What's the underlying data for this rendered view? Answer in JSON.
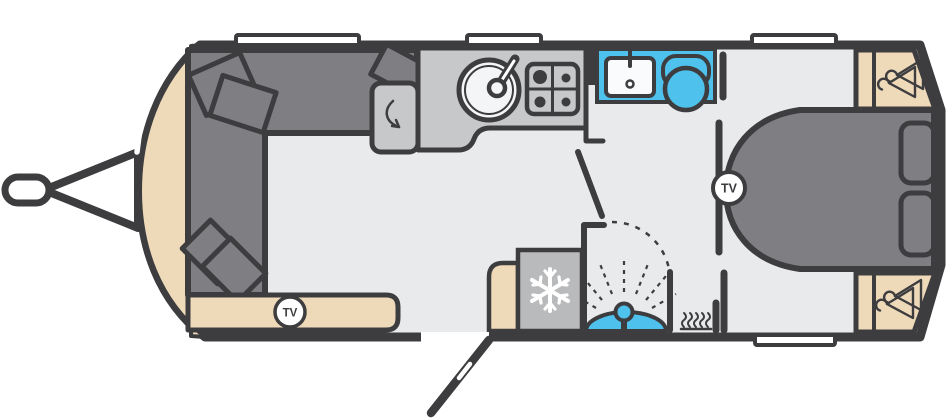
{
  "page": {
    "title": "Caravan floor plan"
  },
  "labels": {
    "tv": "TV"
  },
  "colors": {
    "outline": "#3d3d40",
    "floor": "#e9eaec",
    "upholstery_gray": "#7f7f83",
    "worktop_gray": "#c7c8ca",
    "appliance_gray": "#b9babc",
    "furniture_beige": "#eed9b9",
    "fixture_blue": "#4ec2ec",
    "window_white": "#ffffff",
    "sink_white": "#f4f5f6"
  },
  "floorplan": {
    "vehicle": "touring caravan",
    "areas": [
      {
        "name": "front-lounge",
        "features": [
          "u-shaped-sofa",
          "scatter-cushions-x5",
          "sideboard",
          "tv-point"
        ]
      },
      {
        "name": "kitchen",
        "features": [
          "round-sink-with-tap",
          "four-burner-hob",
          "fridge-with-door-swing"
        ]
      },
      {
        "name": "washroom",
        "features": [
          "vanity-basin-with-tap",
          "toilet",
          "shower-cubicle",
          "freezer",
          "blown-air-heater"
        ]
      },
      {
        "name": "rear-bedroom",
        "features": [
          "island-bed",
          "pillows-x2",
          "wardrobe-with-hanging-x2",
          "tv-point"
        ]
      }
    ],
    "exterior": [
      "tow-hitch",
      "open-entry-door",
      "top-windows-x3",
      "rear-side-window",
      "front-window-dashes-x4"
    ],
    "tv_points": 2
  }
}
